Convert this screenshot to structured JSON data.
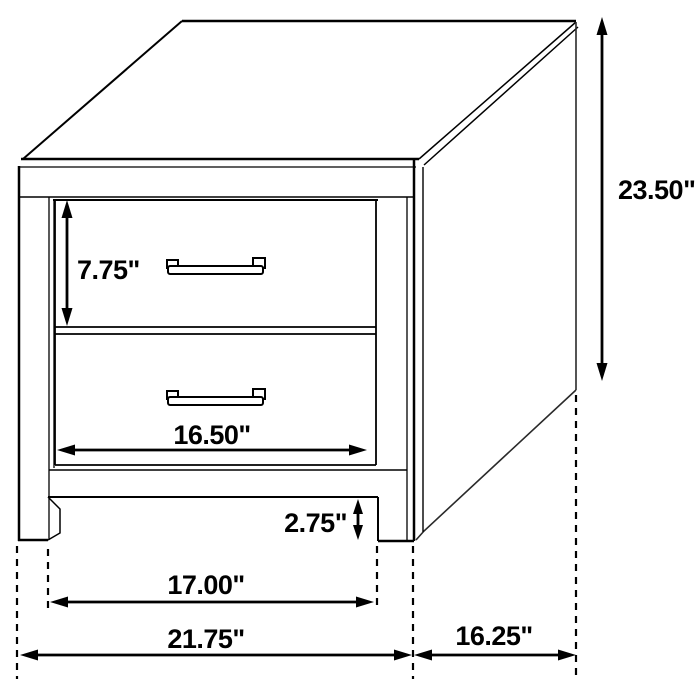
{
  "diagram": {
    "kind": "furniture-dimension-diagram",
    "subject": "two-drawer nightstand line drawing",
    "unit": "inches",
    "line_color": "#000000",
    "background_color": "#ffffff",
    "dimensions": {
      "overall_height": "23.50\"",
      "top_drawer_height": "7.75\"",
      "drawer_front_width": "16.50\"",
      "foot_clearance": "2.75\"",
      "leg_span": "17.00\"",
      "overall_width": "21.75\"",
      "overall_depth": "16.25\""
    }
  }
}
